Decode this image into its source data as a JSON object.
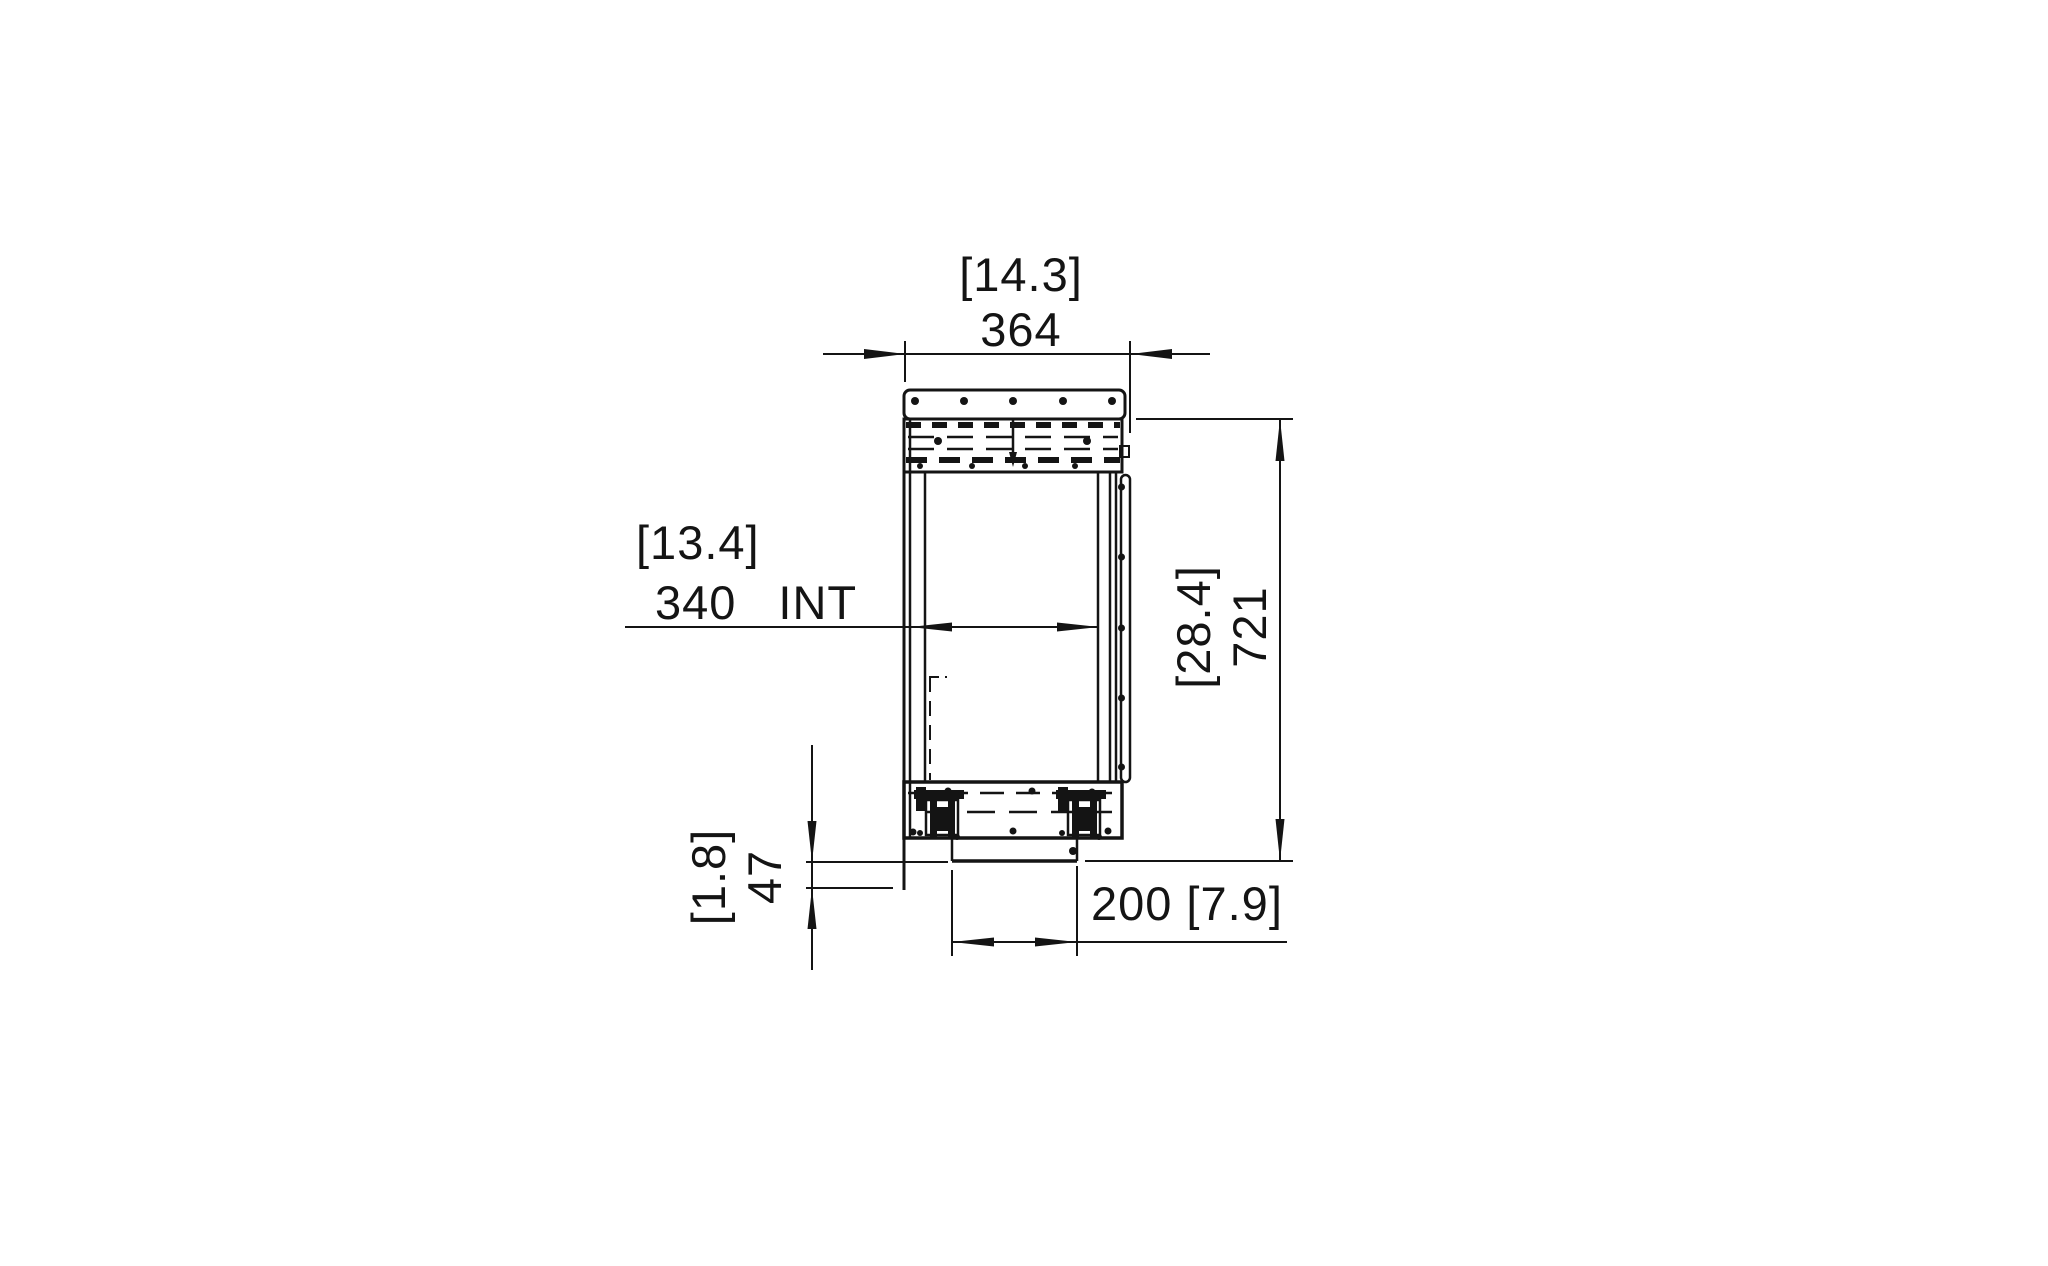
{
  "drawing": {
    "background": "#ffffff",
    "line_color": "#141414",
    "view": "firebox-side-section",
    "dimensions": {
      "top_width": {
        "metric": "364",
        "imperial": "[14.3]"
      },
      "interior_width": {
        "metric": "340",
        "imperial": "[13.4]",
        "suffix": "INT"
      },
      "overall_height": {
        "metric": "721",
        "imperial": "[28.4]"
      },
      "base_drop": {
        "metric": "47",
        "imperial": "[1.8]"
      },
      "bottom_width": {
        "metric": "200",
        "imperial": "[7.9]"
      }
    }
  }
}
